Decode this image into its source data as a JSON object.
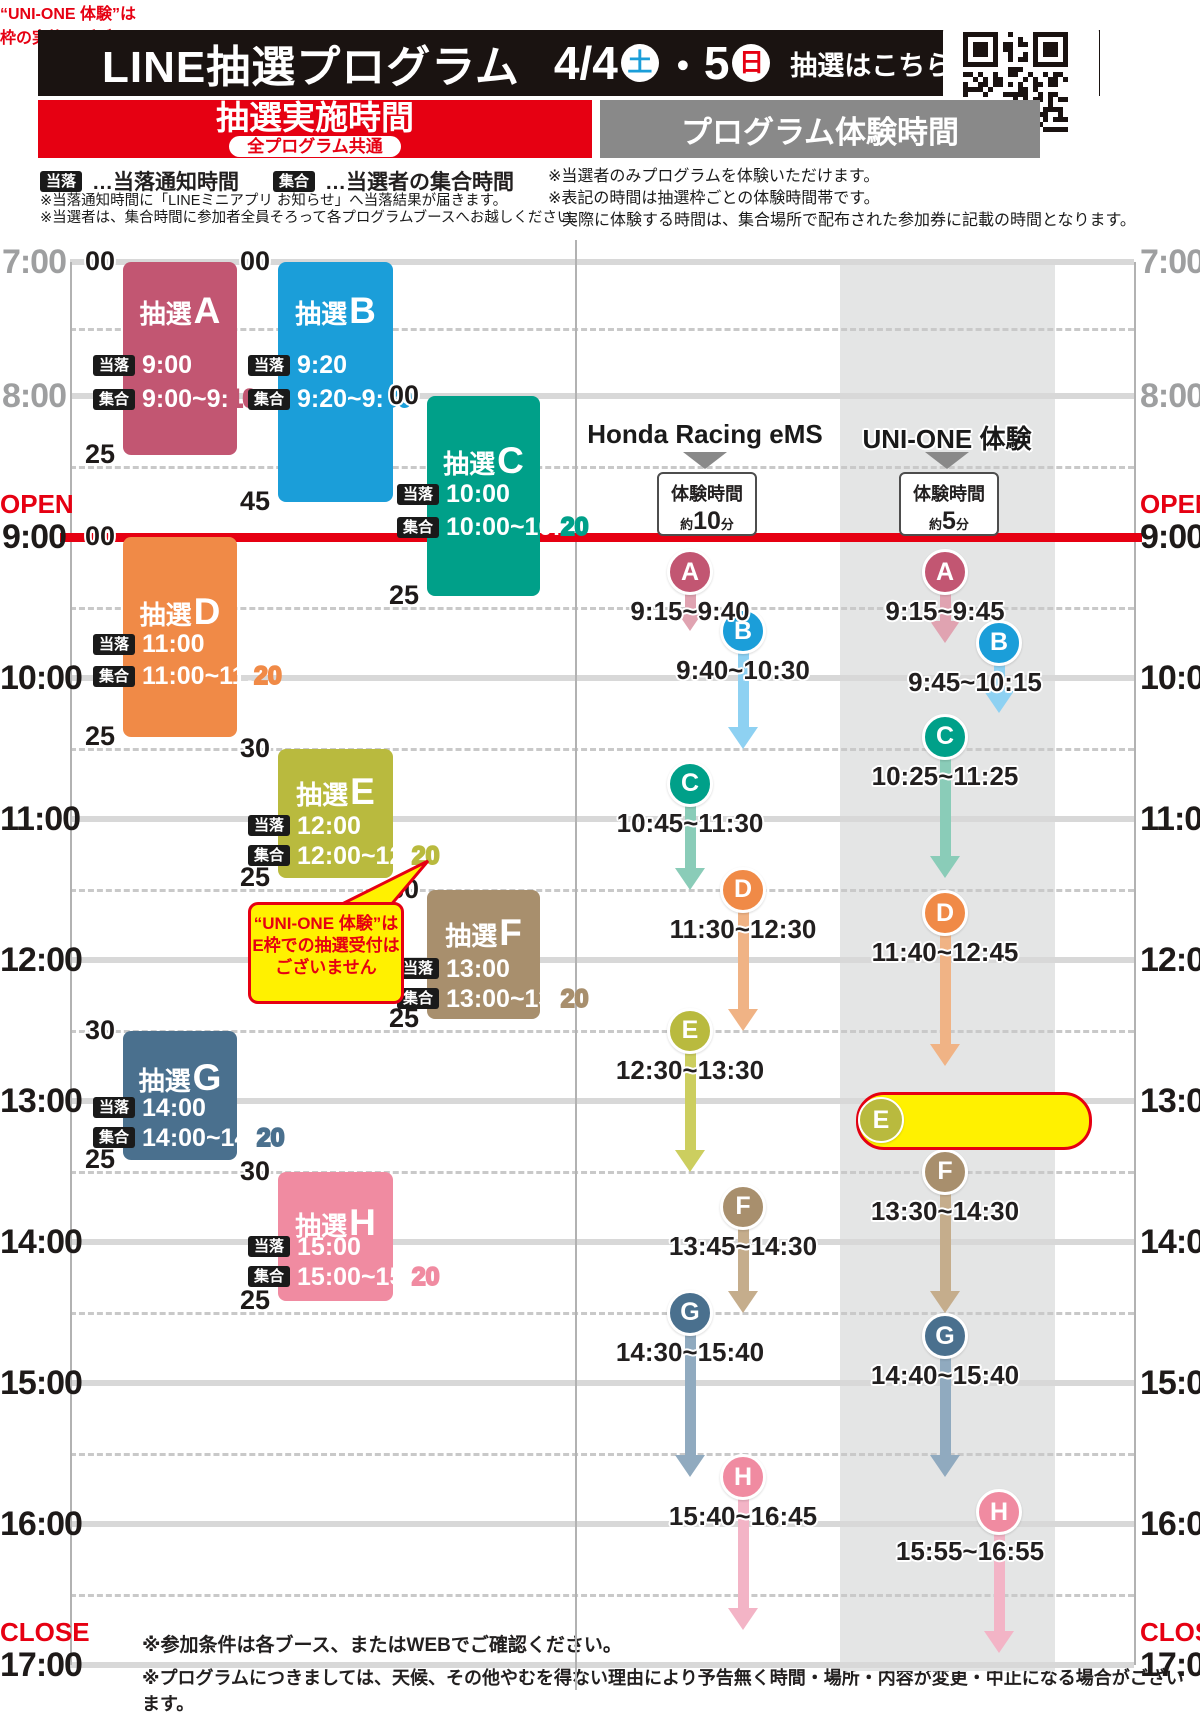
{
  "header": {
    "title": "LINE抽選プログラム",
    "date1": "4/4",
    "day1": "土",
    "dot": "・",
    "date2": "5",
    "day2": "日",
    "qr_cta": "抽選はこちら▶",
    "left_header": "抽選実施時間",
    "left_subheader": "全プログラム共通",
    "right_header": "プログラム体験時間"
  },
  "labels": {
    "touraku": "当落",
    "shugo": "集合",
    "open": "OPEN",
    "close": "CLOSE",
    "lottery_prefix": "抽選"
  },
  "legend": {
    "touraku_desc": "…当落通知時間",
    "shugo_desc": "…当選者の集合時間",
    "left_notes": [
      "※当落通知時間に「LINEミニアプリ お知らせ」へ当落結果が届きます。",
      "※当選者は、集合時間に参加者全員そろって各プログラムブースへお越しください。"
    ],
    "right_notes": [
      "※当選者のみプログラムを体験いただけます。",
      "※表記の時間は抽選枠ごとの体験時間帯です。",
      "実際に体験する時間は、集合場所で配布された参加券に記載の時間となります。"
    ]
  },
  "footer": {
    "notes": [
      "※参加条件は各ブース、またはWEBでご確認ください。",
      "※プログラムにつきましては、天候、その他やむを得ない理由により予告無く時間・場所・内容が変更・中止になる場合がございます。"
    ]
  },
  "colors": {
    "red": "#e60012",
    "band": "#e4e5e5",
    "block": {
      "A": "#c25672",
      "B": "#1b9ed9",
      "C": "#00a089",
      "D": "#f08a47",
      "E": "#b9ba3e",
      "F": "#a88f6d",
      "G": "#4a708e",
      "H": "#f08ba1"
    },
    "arrow": {
      "A": "#e0a3b1",
      "B": "#8ed1f2",
      "C": "#8accb8",
      "D": "#f0b385",
      "E": "#ccce5f",
      "F": "#c5ad8c",
      "G": "#90aabf",
      "H": "#f3b4c6"
    }
  },
  "timeline": {
    "hours": [
      {
        "label": "7:00",
        "t": 7,
        "tone": "gray"
      },
      {
        "label": "8:00",
        "t": 8,
        "tone": "gray"
      },
      {
        "label": "9:00",
        "t": 9,
        "tone": "black",
        "line": "red",
        "tag": "open"
      },
      {
        "label": "10:00",
        "t": 10,
        "tone": "black"
      },
      {
        "label": "11:00",
        "t": 11,
        "tone": "black"
      },
      {
        "label": "12:00",
        "t": 12,
        "tone": "black"
      },
      {
        "label": "13:00",
        "t": 13,
        "tone": "black"
      },
      {
        "label": "14:00",
        "t": 14,
        "tone": "black"
      },
      {
        "label": "15:00",
        "t": 15,
        "tone": "black"
      },
      {
        "label": "16:00",
        "t": 16,
        "tone": "black"
      },
      {
        "label": "17:00",
        "t": 17,
        "tone": "black",
        "tag": "close"
      }
    ]
  },
  "lottery_blocks": [
    {
      "letter": "A",
      "start": 7.0,
      "end": 8.4167,
      "col": 0,
      "top_label": "00",
      "bottom_label": "25",
      "touraku": "9:00",
      "shugo_pre": "9:00~9:",
      "shugo_hollow": "10",
      "title_dy": 50,
      "r1_dy": 104,
      "r2_dy": 138
    },
    {
      "letter": "B",
      "start": 7.0,
      "end": 8.75,
      "col": 1,
      "top_label": "00",
      "bottom_label": "45",
      "touraku": "9:20",
      "shugo_pre": "9:20~9:",
      "shugo_hollow": "30",
      "title_dy": 50,
      "r1_dy": 104,
      "r2_dy": 138
    },
    {
      "letter": "C",
      "start": 8.0,
      "end": 9.4167,
      "col": 2,
      "top_label": "00",
      "bottom_label": "25",
      "touraku": "10:00",
      "shugo_pre": "10:00~10:",
      "shugo_hollow": "20",
      "title_dy": 66,
      "r1_dy": 99,
      "r2_dy": 132
    },
    {
      "letter": "D",
      "start": 9.0,
      "end": 10.4167,
      "col": 0,
      "top_label": "00",
      "bottom_label": "25",
      "touraku": "11:00",
      "shugo_pre": "11:00~11:",
      "shugo_hollow": "20",
      "title_dy": 76,
      "r1_dy": 108,
      "r2_dy": 140
    },
    {
      "letter": "E",
      "start": 10.5,
      "end": 11.4167,
      "col": 1,
      "top_label": "30",
      "bottom_label": "25",
      "touraku": "12:00",
      "shugo_pre": "12:00~12:",
      "shugo_hollow": "20",
      "title_dy": 44,
      "r1_dy": 78,
      "r2_dy": 108
    },
    {
      "letter": "F",
      "start": 11.5,
      "end": 12.4167,
      "col": 2,
      "top_label": "30",
      "bottom_label": "25",
      "touraku": "13:00",
      "shugo_pre": "13:00~13:",
      "shugo_hollow": "20",
      "title_dy": 44,
      "r1_dy": 80,
      "r2_dy": 110
    },
    {
      "letter": "G",
      "start": 12.5,
      "end": 13.4167,
      "col": 0,
      "top_label": "30",
      "bottom_label": "25",
      "touraku": "14:00",
      "shugo_pre": "14:00~14:",
      "shugo_hollow": "20",
      "title_dy": 48,
      "r1_dy": 78,
      "r2_dy": 108
    },
    {
      "letter": "H",
      "start": 13.5,
      "end": 14.4167,
      "col": 1,
      "top_label": "30",
      "bottom_label": "25",
      "touraku": "15:00",
      "shugo_pre": "15:00~15:",
      "shugo_hollow": "20",
      "title_dy": 52,
      "r1_dy": 76,
      "r2_dy": 106
    }
  ],
  "block_columns": [
    {
      "x": 123,
      "w": 114
    },
    {
      "x": 278,
      "w": 115
    },
    {
      "x": 427,
      "w": 113
    }
  ],
  "experience_columns": [
    {
      "name": "Honda Racing eMS",
      "center_x": 705,
      "duration_label": "体験時間",
      "duration_prefix": "約",
      "duration_num": "10",
      "duration_suffix": "分",
      "entries": [
        {
          "letter": "A",
          "time": "9:15~9:40",
          "start": 9.25,
          "end": 9.6667,
          "x": 690
        },
        {
          "letter": "B",
          "time": "9:40~10:30",
          "start": 9.6667,
          "end": 10.5,
          "x": 743
        },
        {
          "letter": "C",
          "time": "10:45~11:30",
          "start": 10.75,
          "end": 11.5,
          "x": 690
        },
        {
          "letter": "D",
          "time": "11:30~12:30",
          "start": 11.5,
          "end": 12.5,
          "x": 743
        },
        {
          "letter": "E",
          "time": "12:30~13:30",
          "start": 12.5,
          "end": 13.5,
          "x": 690
        },
        {
          "letter": "F",
          "time": "13:45~14:30",
          "start": 13.75,
          "end": 14.5,
          "x": 743
        },
        {
          "letter": "G",
          "time": "14:30~15:40",
          "start": 14.5,
          "end": 15.6667,
          "x": 690
        },
        {
          "letter": "H",
          "time": "15:40~16:45",
          "start": 15.6667,
          "end": 16.75,
          "x": 743
        }
      ]
    },
    {
      "name": "UNI-ONE 体験",
      "center_x": 947,
      "duration_label": "体験時間",
      "duration_prefix": "約",
      "duration_num": "5",
      "duration_suffix": "分",
      "entries": [
        {
          "letter": "A",
          "time": "9:15~9:45",
          "start": 9.25,
          "end": 9.75,
          "x": 945
        },
        {
          "letter": "B",
          "time": "9:45~10:15",
          "start": 9.75,
          "end": 10.25,
          "x": 999,
          "label_x": 975
        },
        {
          "letter": "C",
          "time": "10:25~11:25",
          "start": 10.4167,
          "end": 11.4167,
          "x": 945
        },
        {
          "letter": "D",
          "time": "11:40~12:45",
          "start": 11.6667,
          "end": 12.75,
          "x": 945
        },
        {
          "letter": "F",
          "time": "13:30~14:30",
          "start": 13.5,
          "end": 14.5,
          "x": 945
        },
        {
          "letter": "G",
          "time": "14:40~15:40",
          "start": 14.6667,
          "end": 15.6667,
          "x": 945
        },
        {
          "letter": "H",
          "time": "15:55~16:55",
          "start": 15.9167,
          "end": 16.9167,
          "x": 999,
          "label_x": 970
        }
      ]
    }
  ],
  "callouts": {
    "block_e": {
      "lines": [
        "“UNI-ONE 体験”は",
        "E枠での抽選受付は",
        "ございません"
      ],
      "x": 248,
      "y": 902,
      "w": 150,
      "h": 88
    },
    "uni_one_e": {
      "badge": "E",
      "line1": "“UNI-ONE 体験”は",
      "line2": "枠の実施はございません",
      "x": 856,
      "y": 1092,
      "w": 230,
      "h": 52
    }
  },
  "geometry": {
    "band": {
      "x": 840,
      "w": 215,
      "top_t": 7,
      "bottom_t": 17
    },
    "axis_left_x": 70,
    "axis_right_x": 1134,
    "separator_x": 575,
    "grid_x1": 70,
    "grid_x2": 1134,
    "col_header_y": 435,
    "tri_y": 452,
    "durbox_y": 472
  }
}
